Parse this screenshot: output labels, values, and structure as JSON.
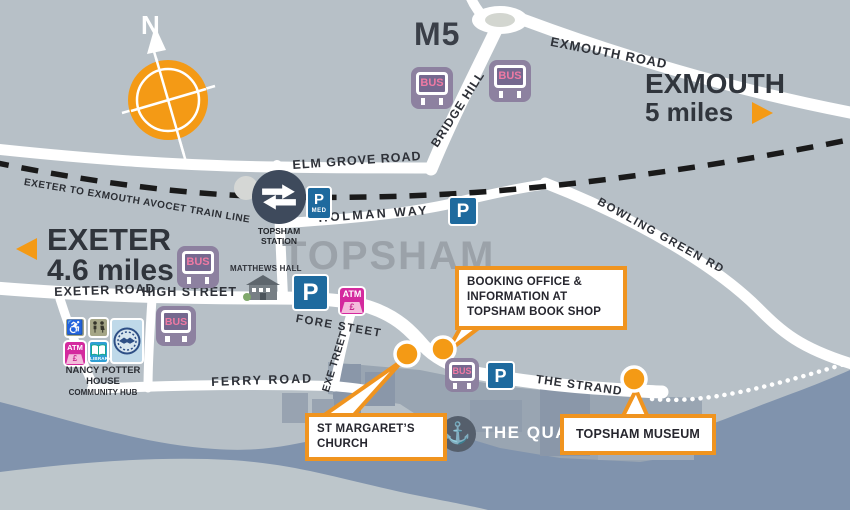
{
  "colors": {
    "land": "#B7C0C7",
    "water": "#8093AD",
    "mudflat": "#BDC6CB",
    "road": "#FFFFFF",
    "accent_orange": "#F49A15",
    "callout_border": "#F0941F",
    "parking_blue": "#1E6A9E",
    "bus_purple": "#8D81A0",
    "atm_magenta": "#D42A9E",
    "library_blue": "#2F9FD4",
    "station_navy": "#3E4A5C",
    "text_dark": "#2E3138"
  },
  "compass": {
    "north_label": "N"
  },
  "labels": {
    "motorway": "M5",
    "town": "TOPSHAM",
    "train_line": "EXETER TO EXMOUTH AVOCET TRAIN LINE"
  },
  "destinations": {
    "exmouth": {
      "name": "EXMOUTH",
      "distance": "5 miles"
    },
    "exeter": {
      "name": "EXETER",
      "distance": "4.6 miles"
    }
  },
  "roads": {
    "exmouth_road": "EXMOUTH ROAD",
    "bridge_hill": "BRIDGE HILL",
    "elm_grove_road": "ELM GROVE ROAD",
    "holman_way": "HOLMAN WAY",
    "bowling_green_rd": "BOWLING GREEN RD",
    "exeter_road": "EXETER ROAD",
    "high_street": "HIGH STREET",
    "fore_street": "FORE STEET",
    "exe_street": "EXE TREET",
    "ferry_road": "FERRY ROAD",
    "the_strand": "THE STRAND"
  },
  "station": {
    "label": "TOPSHAM STATION"
  },
  "places": {
    "matthews_hall": "MATTHEWS HALL",
    "nancy_potter_house": {
      "line1": "NANCY POTTER",
      "line2": "HOUSE",
      "line3": "COMMUNITY HUB"
    },
    "the_quay": "THE QUAY"
  },
  "callouts": {
    "booking_office": {
      "line1": "BOOKING OFFICE &",
      "line2": "INFORMATION AT",
      "line3": "TOPSHAM BOOK SHOP"
    },
    "st_margarets": {
      "line1": "ST MARGARET’S",
      "line2": "CHURCH"
    },
    "museum": {
      "line1": "TOPSHAM MUSEUM"
    }
  },
  "icons": {
    "bus": "BUS",
    "parking": "P",
    "parking_med": "MED",
    "atm": "ATM",
    "atm_pound": "£",
    "library": "LIBRARY",
    "anchor": "⚓",
    "wheelchair": "♿"
  }
}
